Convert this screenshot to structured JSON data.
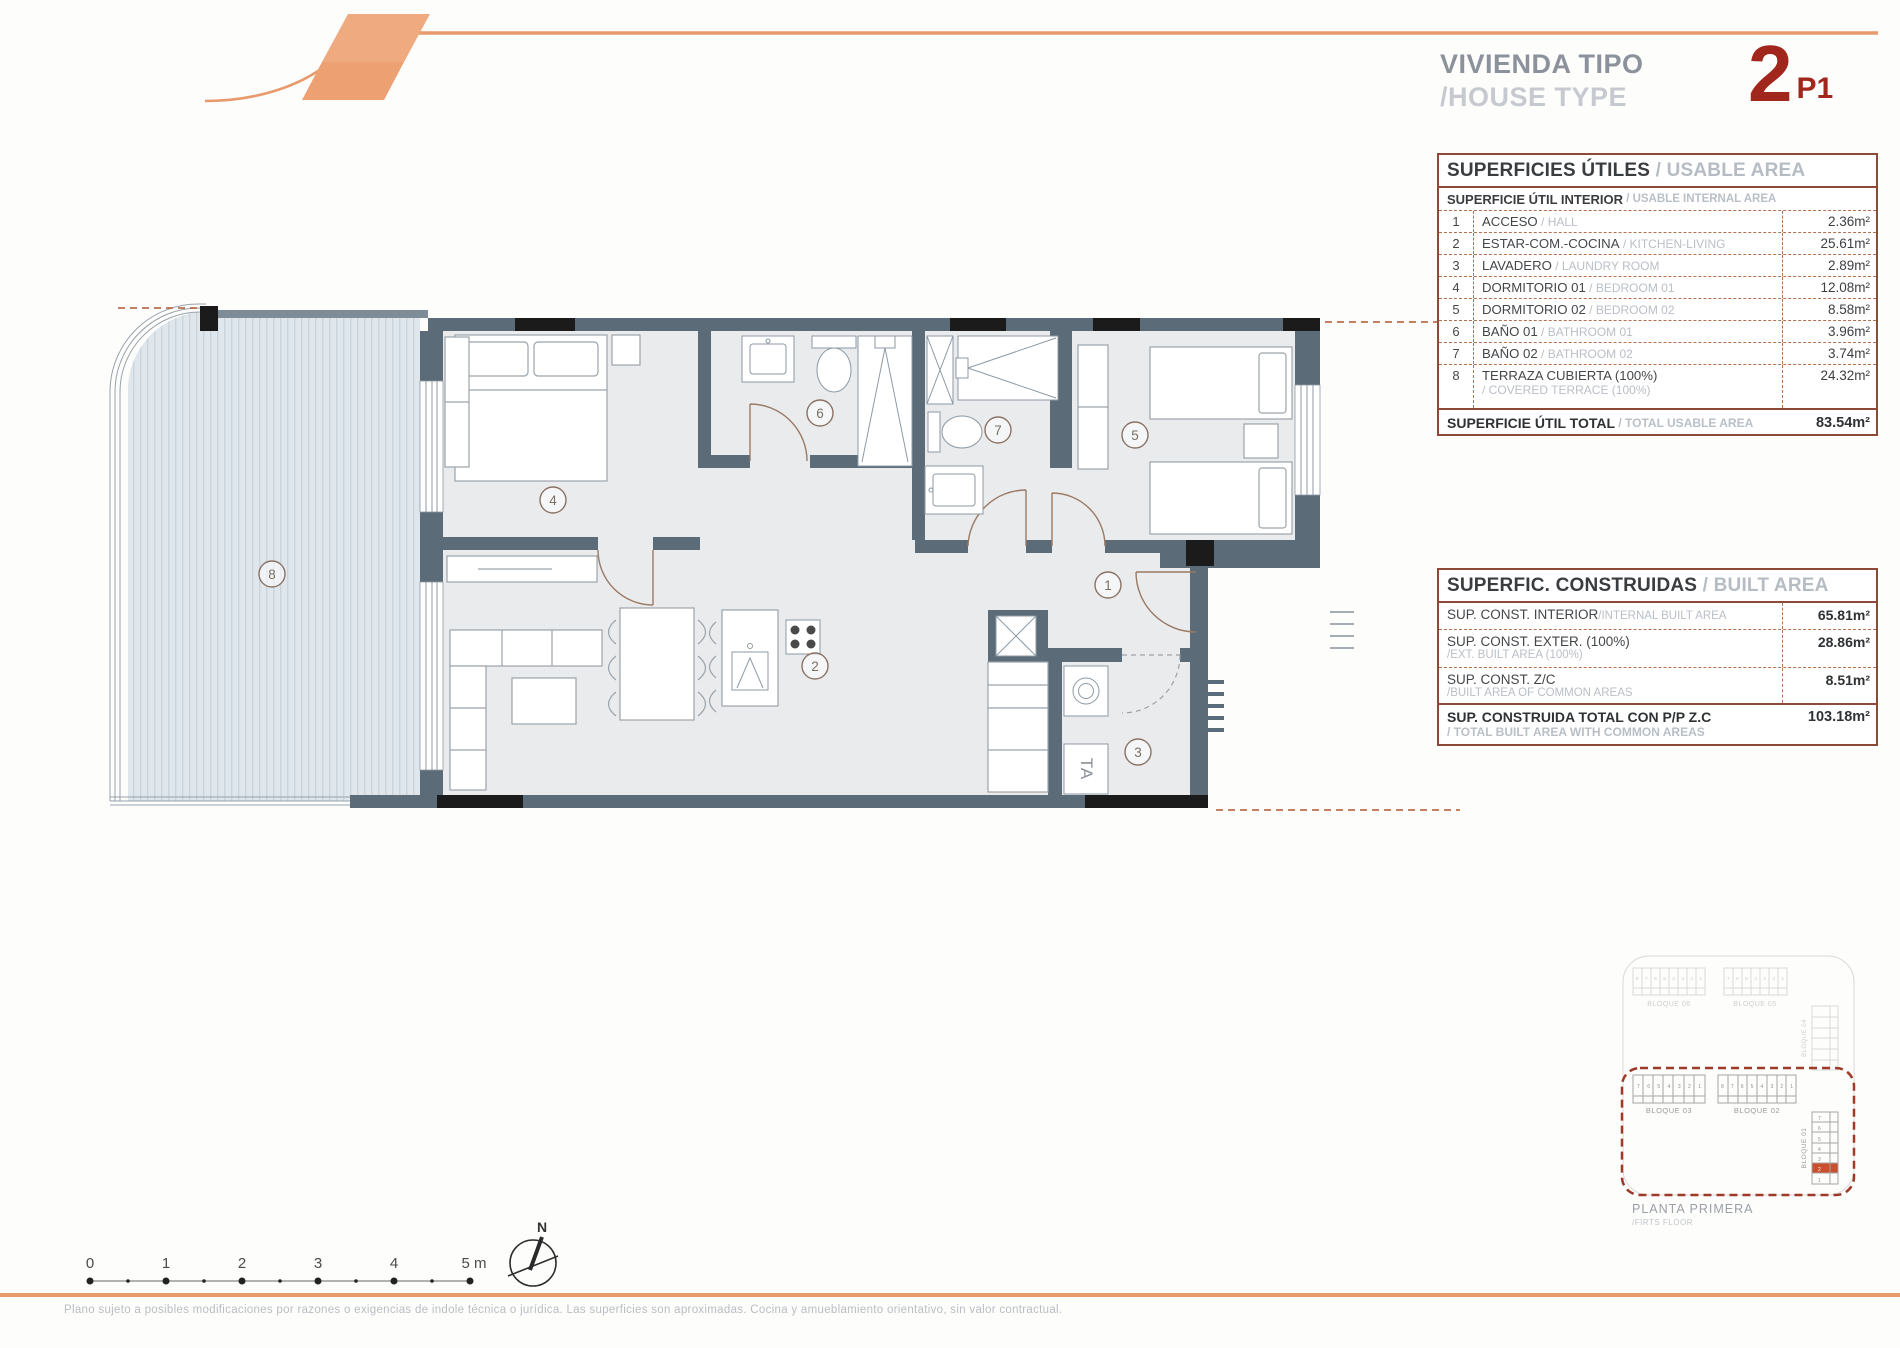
{
  "header": {
    "title_es": "VIVIENDA TIPO",
    "title_en": "/HOUSE TYPE",
    "type_number": "2",
    "type_floor": "P1"
  },
  "usable_table": {
    "title_es": "SUPERFICIES ÚTILES",
    "title_en": " / USABLE AREA",
    "subtitle_es": "SUPERFICIE ÚTIL INTERIOR",
    "subtitle_en": " / USABLE INTERNAL AREA",
    "rows": [
      {
        "num": "1",
        "name_es": "ACCESO",
        "name_en": " / HALL",
        "value": "2.36m²"
      },
      {
        "num": "2",
        "name_es": "ESTAR-COM.-COCINA",
        "name_en": " / KITCHEN-LIVING",
        "value": "25.61m²"
      },
      {
        "num": "3",
        "name_es": "LAVADERO",
        "name_en": " / LAUNDRY ROOM",
        "value": "2.89m²"
      },
      {
        "num": "4",
        "name_es": "DORMITORIO 01",
        "name_en": " / BEDROOM 01",
        "value": "12.08m²"
      },
      {
        "num": "5",
        "name_es": "DORMITORIO 02",
        "name_en": " / BEDROOM 02",
        "value": "8.58m²"
      },
      {
        "num": "6",
        "name_es": "BAÑO 01",
        "name_en": " / BATHROOM 01",
        "value": "3.96m²"
      },
      {
        "num": "7",
        "name_es": "BAÑO 02",
        "name_en": " / BATHROOM 02",
        "value": "3.74m²"
      },
      {
        "num": "8",
        "name_es": "TERRAZA CUBIERTA (100%)",
        "name_en": "/ COVERED TERRACE (100%)",
        "value": "24.32m²"
      }
    ],
    "total_es": "SUPERFICIE ÚTIL TOTAL",
    "total_en": " / TOTAL USABLE AREA",
    "total_value": "83.54m²"
  },
  "built_table": {
    "title_es": "SUPERFIC. CONSTRUIDAS",
    "title_en": " / BUILT AREA",
    "rows": [
      {
        "name_es": "SUP. CONST. INTERIOR",
        "name_en": "/INTERNAL BUILT AREA",
        "inline": true,
        "value": "65.81m²"
      },
      {
        "name_es": "SUP. CONST. EXTER. (100%)",
        "name_en": "/EXT. BUILT AREA (100%)",
        "inline": false,
        "value": "28.86m²"
      },
      {
        "name_es": "SUP. CONST. Z/C",
        "name_en": "/BUILT AREA OF COMMON AREAS",
        "inline": false,
        "value": "8.51m²"
      }
    ],
    "total_es": "SUP. CONSTRUIDA TOTAL CON P/P Z.C",
    "total_en": "/ TOTAL BUILT AREA WITH COMMON AREAS",
    "total_value": "103.18m²"
  },
  "plan": {
    "rooms": [
      "1",
      "2",
      "3",
      "4",
      "5",
      "6",
      "7",
      "8"
    ],
    "ta_label": "TA"
  },
  "scale_bar": {
    "labels": [
      "0",
      "1",
      "2",
      "3",
      "4",
      "5 m"
    ]
  },
  "north_label": "N",
  "site_plan": {
    "b06": "BLOQUE 06",
    "b05": "BLOQUE 05",
    "b04": "BLOQUE 04",
    "b03": "BLOQUE 03",
    "b02": "BLOQUE 02",
    "b01": "BLOQUE 01",
    "b06_nums": "8 7 6 5 4 3 2 1",
    "b05_nums": "7 6 5 4 3 2 1",
    "b03_nums": "7 6 5 4 3 2 1",
    "b02_nums": "8 7 6 5 4 3 2 1",
    "b01_nums": [
      "7",
      "6",
      "5",
      "4",
      "3",
      "2",
      "1"
    ],
    "caption_es": "PLANTA PRIMERA",
    "caption_en": "/FIRTS FLOOR"
  },
  "footer": {
    "disclaimer": "Plano sujeto a posibles modificaciones por razones o exigencias de indole técnica o jurídica. Las superficies son aproximadas. Cocina y amueblamiento orientativo, sin valor contractual."
  },
  "colors": {
    "accent_orange": "#E89A6C",
    "brand_red": "#A1261B",
    "wall_slate": "#5C6B78",
    "table_border": "#8E4A39",
    "highlight_unit": "#C94F2E"
  }
}
